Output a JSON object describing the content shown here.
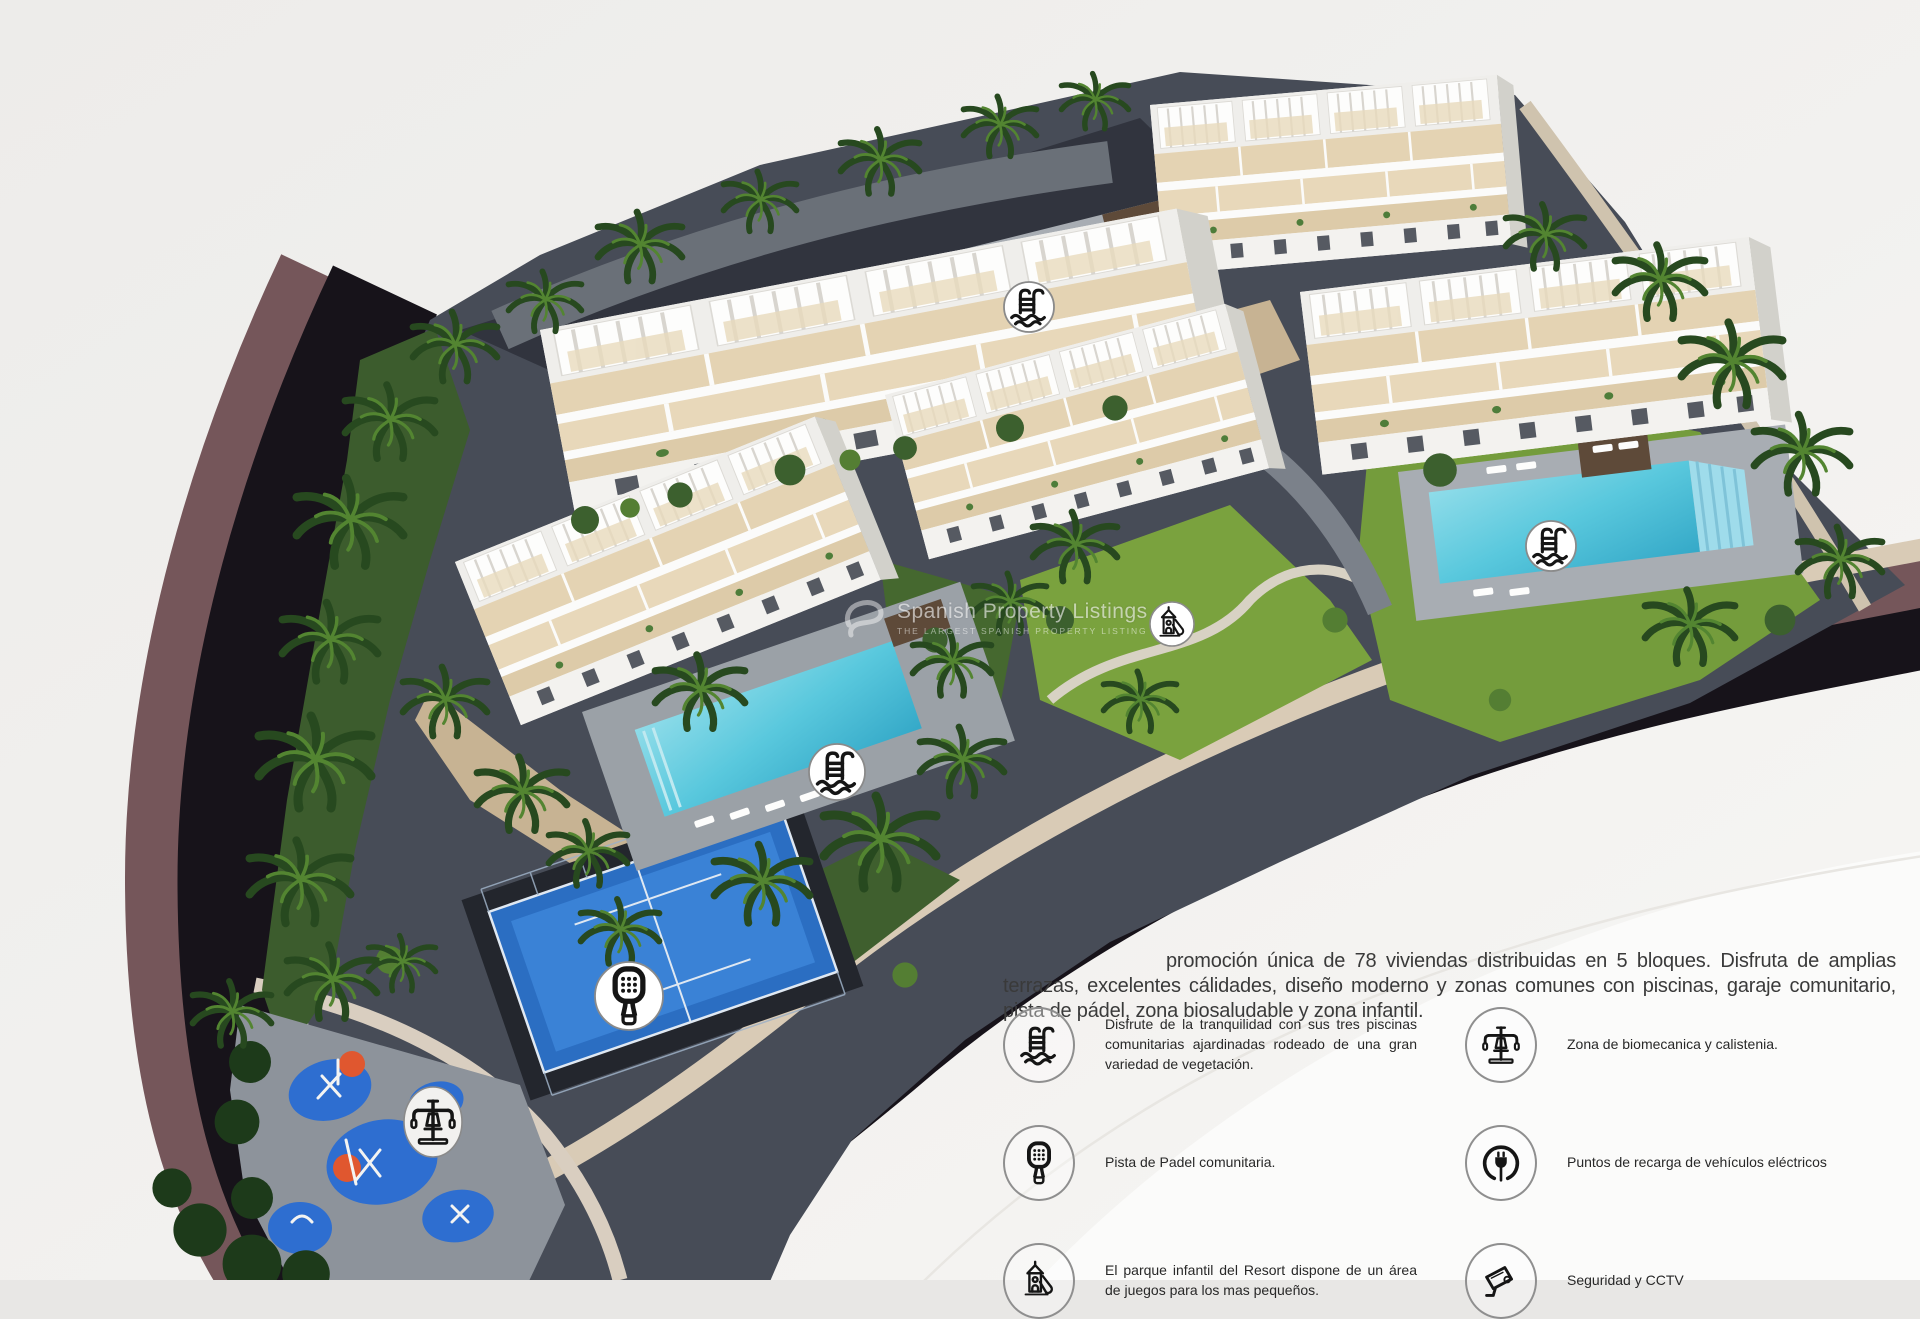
{
  "watermark": {
    "title": "Spanish Property Listings",
    "subtitle": "THE LARGEST SPANISH PROPERTY LISTING"
  },
  "description": {
    "text": "promoción única de 78 viviendas distribuidas en 5 bloques. Disfruta de amplias terrazas, excelentes cálidades, diseño moderno y zonas comunes con piscinas, garaje comunitario, pista de pádel, zona biosaludable y zona infantil."
  },
  "legend": {
    "items": [
      {
        "icon": "pool-ladder-icon",
        "text": "Disfrute de la tranquilidad con sus tres piscinas comunitarias ajardinadas rodeado de una gran variedad de vegetación."
      },
      {
        "icon": "biomechanics-icon",
        "text": "Zona de biomecanica y calistenia."
      },
      {
        "icon": "padel-racket-icon",
        "text": "Pista de Padel comunitaria."
      },
      {
        "icon": "ev-charger-icon",
        "text": "Puntos de recarga de vehículos eléctricos"
      },
      {
        "icon": "playground-icon",
        "text": "El parque infantil del Resort dispone de un área de juegos para los mas pequeños."
      },
      {
        "icon": "cctv-icon",
        "text": "Seguridad y CCTV"
      }
    ]
  },
  "map": {
    "markers": [
      {
        "icon": "pool-ladder-icon"
      },
      {
        "icon": "pool-ladder-icon"
      },
      {
        "icon": "pool-ladder-icon"
      },
      {
        "icon": "padel-racket-icon"
      },
      {
        "icon": "playground-icon"
      },
      {
        "icon": "biomechanics-icon"
      }
    ]
  },
  "colors": {
    "background": "#f2f1ef",
    "road": "#17131a",
    "embankment": "#75565a",
    "pool_water": "#59c8dd",
    "padel_court": "#2b6ec2",
    "lawn": "#7aa23e",
    "stone_path": "#d9cbb6",
    "icon_ink": "#151515",
    "body_text": "#3a3a3a"
  }
}
